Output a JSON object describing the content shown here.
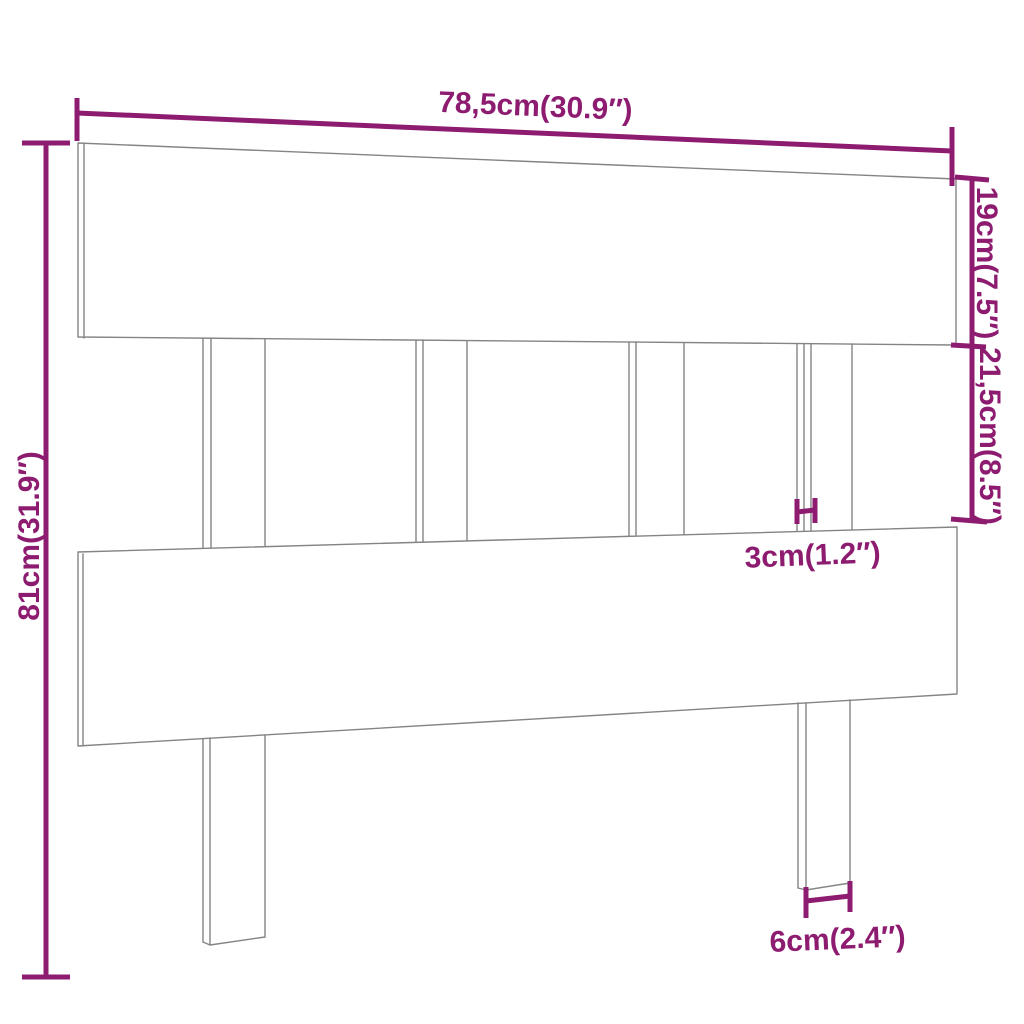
{
  "colors": {
    "accent": "#8d1c70",
    "outline": "#848484",
    "background": "#ffffff"
  },
  "diagram": {
    "subject": "headboard-dimension-diagram",
    "dimensions": {
      "total_width": "78,5cm(30.9″)",
      "top_board_height": "19cm(7.5″)",
      "gap_height": "21,5cm(8.5″)",
      "total_height": "81cm(31.9″)",
      "slat_thickness": "3cm(1.2″)",
      "leg_width": "6cm(2.4″)"
    }
  }
}
